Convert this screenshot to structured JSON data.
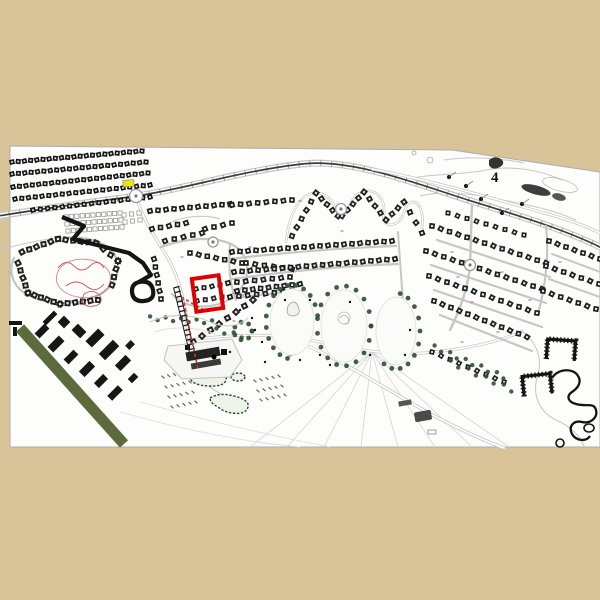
{
  "meta": {
    "kind": "resort-master-plan-map",
    "sheet_rotation_note": "white plan sheet on tan background"
  },
  "palette": {
    "bg": "#d9c49a",
    "sheet": "#fdfdfc",
    "road": "#c6c6c6",
    "roadDark": "#3c3c3c",
    "house": "#1f1f1f",
    "houseLight": "#e9e9e9",
    "tree": "#2f5233",
    "greenStripe": "#5d6b3c",
    "highlight": "#e10000",
    "redLine": "#c63434",
    "yellow": "#efe40a",
    "ink": "#141414"
  },
  "labels": {
    "sector": "4",
    "sector_pos": [
      491,
      182
    ]
  },
  "sheet": {
    "corners": [
      [
        10,
        146
      ],
      [
        452,
        150
      ],
      [
        600,
        172
      ],
      [
        600,
        447
      ],
      [
        10,
        447
      ]
    ]
  },
  "highlight_box": {
    "x": 194,
    "y": 277,
    "w": 27,
    "h": 33,
    "rot": -8,
    "stroke_w": 4
  },
  "yellow_marker": {
    "x": 123,
    "y": 180,
    "w": 11,
    "h": 6.5,
    "rot": -4
  },
  "terrace_rows": [
    [
      12,
      162,
      142,
      151,
      22,
      5
    ],
    [
      12,
      174,
      146,
      162,
      22,
      5
    ],
    [
      13,
      187,
      148,
      173,
      22,
      5
    ],
    [
      15,
      199,
      150,
      185,
      21,
      5
    ],
    [
      33,
      210,
      150,
      197,
      17,
      5
    ]
  ],
  "house_rows": [
    [
      150,
      211,
      230,
      204,
      11,
      5.5
    ],
    [
      232,
      205,
      292,
      200,
      8,
      5.5
    ],
    [
      292,
      236,
      316,
      193,
      6,
      5.5
    ],
    [
      316,
      193,
      338,
      216,
      5,
      5.5
    ],
    [
      342,
      216,
      364,
      192,
      5,
      5.5
    ],
    [
      364,
      192,
      386,
      220,
      5,
      5.5
    ],
    [
      386,
      220,
      404,
      202,
      4,
      5.5
    ],
    [
      404,
      202,
      422,
      233,
      4,
      5.5
    ],
    [
      22,
      252,
      58,
      239,
      6,
      6
    ],
    [
      58,
      239,
      96,
      243,
      6,
      6
    ],
    [
      96,
      243,
      118,
      261,
      4,
      6
    ],
    [
      118,
      261,
      112,
      285,
      4,
      6
    ],
    [
      18,
      263,
      28,
      293,
      5,
      6
    ],
    [
      28,
      293,
      60,
      304,
      6,
      6
    ],
    [
      60,
      304,
      98,
      300,
      6,
      6
    ],
    [
      152,
      229,
      186,
      223,
      5,
      5.5
    ],
    [
      165,
      241,
      202,
      233,
      5,
      5.5
    ],
    [
      205,
      229,
      232,
      223,
      4,
      5.5
    ],
    [
      154,
      259,
      161,
      299,
      6,
      5.5
    ],
    [
      190,
      253,
      242,
      263,
      7,
      5.5
    ],
    [
      246,
      263,
      292,
      269,
      6,
      5.5
    ],
    [
      196,
      289,
      220,
      285,
      4,
      5
    ],
    [
      197,
      301,
      222,
      297,
      4,
      5
    ],
    [
      228,
      283,
      290,
      277,
      8,
      5.5
    ],
    [
      230,
      297,
      292,
      291,
      8,
      5.5
    ],
    [
      232,
      252,
      392,
      241,
      21,
      5.5
    ],
    [
      234,
      272,
      395,
      259,
      21,
      5.5
    ],
    [
      237,
      291,
      300,
      284,
      9,
      5.5
    ],
    [
      432,
      226,
      546,
      263,
      14,
      5.5
    ],
    [
      426,
      251,
      542,
      289,
      14,
      5.5
    ],
    [
      429,
      276,
      537,
      313,
      13,
      5.5
    ],
    [
      434,
      301,
      527,
      337,
      12,
      5.5
    ],
    [
      448,
      213,
      524,
      235,
      9,
      5
    ],
    [
      549,
      241,
      600,
      259,
      7,
      5.5
    ],
    [
      546,
      266,
      599,
      284,
      7,
      5.5
    ],
    [
      543,
      291,
      596,
      309,
      7,
      5.5
    ],
    [
      253,
      300,
      168,
      360,
      11,
      6
    ],
    [
      432,
      352,
      504,
      382,
      9,
      5
    ]
  ],
  "parking_rows": [
    [
      66,
      217,
      120,
      213,
      11,
      4.2
    ],
    [
      67,
      224,
      121,
      220,
      11,
      4.2
    ],
    [
      68,
      231,
      122,
      227,
      11,
      4.2
    ],
    [
      124,
      215,
      139,
      213,
      3,
      4.2
    ],
    [
      125,
      222,
      140,
      220,
      3,
      4.2
    ]
  ],
  "tree_rings": [
    [
      292,
      322,
      26,
      37,
      15,
      100,
      350
    ],
    [
      344,
      326,
      27,
      40,
      18,
      0,
      360
    ],
    [
      396,
      331,
      24,
      38,
      11,
      -80,
      120
    ],
    [
      243,
      331,
      9,
      9,
      8,
      0,
      360
    ]
  ],
  "tree_rows": [
    [
      150,
      318,
      212,
      322,
      9
    ],
    [
      216,
      330,
      242,
      336,
      4
    ],
    [
      434,
      347,
      504,
      377,
      10
    ],
    [
      450,
      362,
      512,
      390,
      8
    ]
  ],
  "hotel_blocks": [
    [
      42,
      331,
      14,
      7,
      -45
    ],
    [
      56,
      344,
      16,
      8,
      -45
    ],
    [
      71,
      357,
      14,
      7,
      -45
    ],
    [
      87,
      369,
      15,
      8,
      -45
    ],
    [
      101,
      381,
      13,
      7,
      -45
    ],
    [
      115,
      393,
      15,
      7,
      -45
    ],
    [
      95,
      338,
      18,
      9,
      -45
    ],
    [
      109,
      350,
      20,
      9,
      -45
    ],
    [
      123,
      363,
      15,
      8,
      -45
    ],
    [
      79,
      331,
      9,
      12,
      -45
    ],
    [
      64,
      322,
      9,
      9,
      -45
    ],
    [
      133,
      378,
      9,
      6,
      -45
    ],
    [
      36,
      346,
      7,
      10,
      -45
    ],
    [
      130,
      345,
      8,
      6,
      -45
    ],
    [
      50,
      318,
      16,
      5,
      -45
    ]
  ],
  "hatch_rows": [
    [
      163,
      377,
      186,
      372,
      5
    ],
    [
      166,
      387,
      190,
      382,
      5
    ],
    [
      169,
      397,
      193,
      392,
      5
    ],
    [
      172,
      407,
      196,
      402,
      5
    ],
    [
      255,
      381,
      279,
      376,
      5
    ],
    [
      258,
      391,
      282,
      386,
      5
    ],
    [
      261,
      400,
      285,
      395,
      5
    ]
  ],
  "red_ticks": [
    [
      250,
      247
    ],
    [
      252,
      267
    ],
    [
      320,
      248
    ],
    [
      322,
      265
    ],
    [
      362,
      244
    ],
    [
      452,
      252
    ],
    [
      458,
      277
    ],
    [
      472,
      302
    ],
    [
      502,
      272
    ],
    [
      560,
      262
    ],
    [
      252,
      287
    ],
    [
      182,
      257
    ],
    [
      300,
      201
    ],
    [
      342,
      231
    ],
    [
      498,
      332
    ],
    [
      462,
      342
    ],
    [
      234,
      321
    ],
    [
      290,
      356
    ],
    [
      500,
      246
    ],
    [
      530,
      300
    ]
  ],
  "roundabouts": [
    [
      136,
      196,
      6.5
    ],
    [
      470,
      265,
      5.5
    ],
    [
      341,
      209,
      5.5
    ],
    [
      213,
      242,
      5
    ]
  ],
  "specks": [
    [
      252,
      318
    ],
    [
      262,
      342
    ],
    [
      300,
      360
    ],
    [
      285,
      300
    ],
    [
      240,
      310
    ],
    [
      230,
      352
    ],
    [
      265,
      362
    ],
    [
      310,
      300
    ],
    [
      350,
      302
    ],
    [
      370,
      355
    ],
    [
      410,
      330
    ],
    [
      330,
      365
    ],
    [
      255,
      330
    ],
    [
      320,
      355
    ],
    [
      405,
      355
    ]
  ],
  "pond_dots": [
    [
      466,
      186
    ],
    [
      481,
      199
    ],
    [
      502,
      213
    ],
    [
      449,
      177
    ],
    [
      522,
      204
    ]
  ]
}
